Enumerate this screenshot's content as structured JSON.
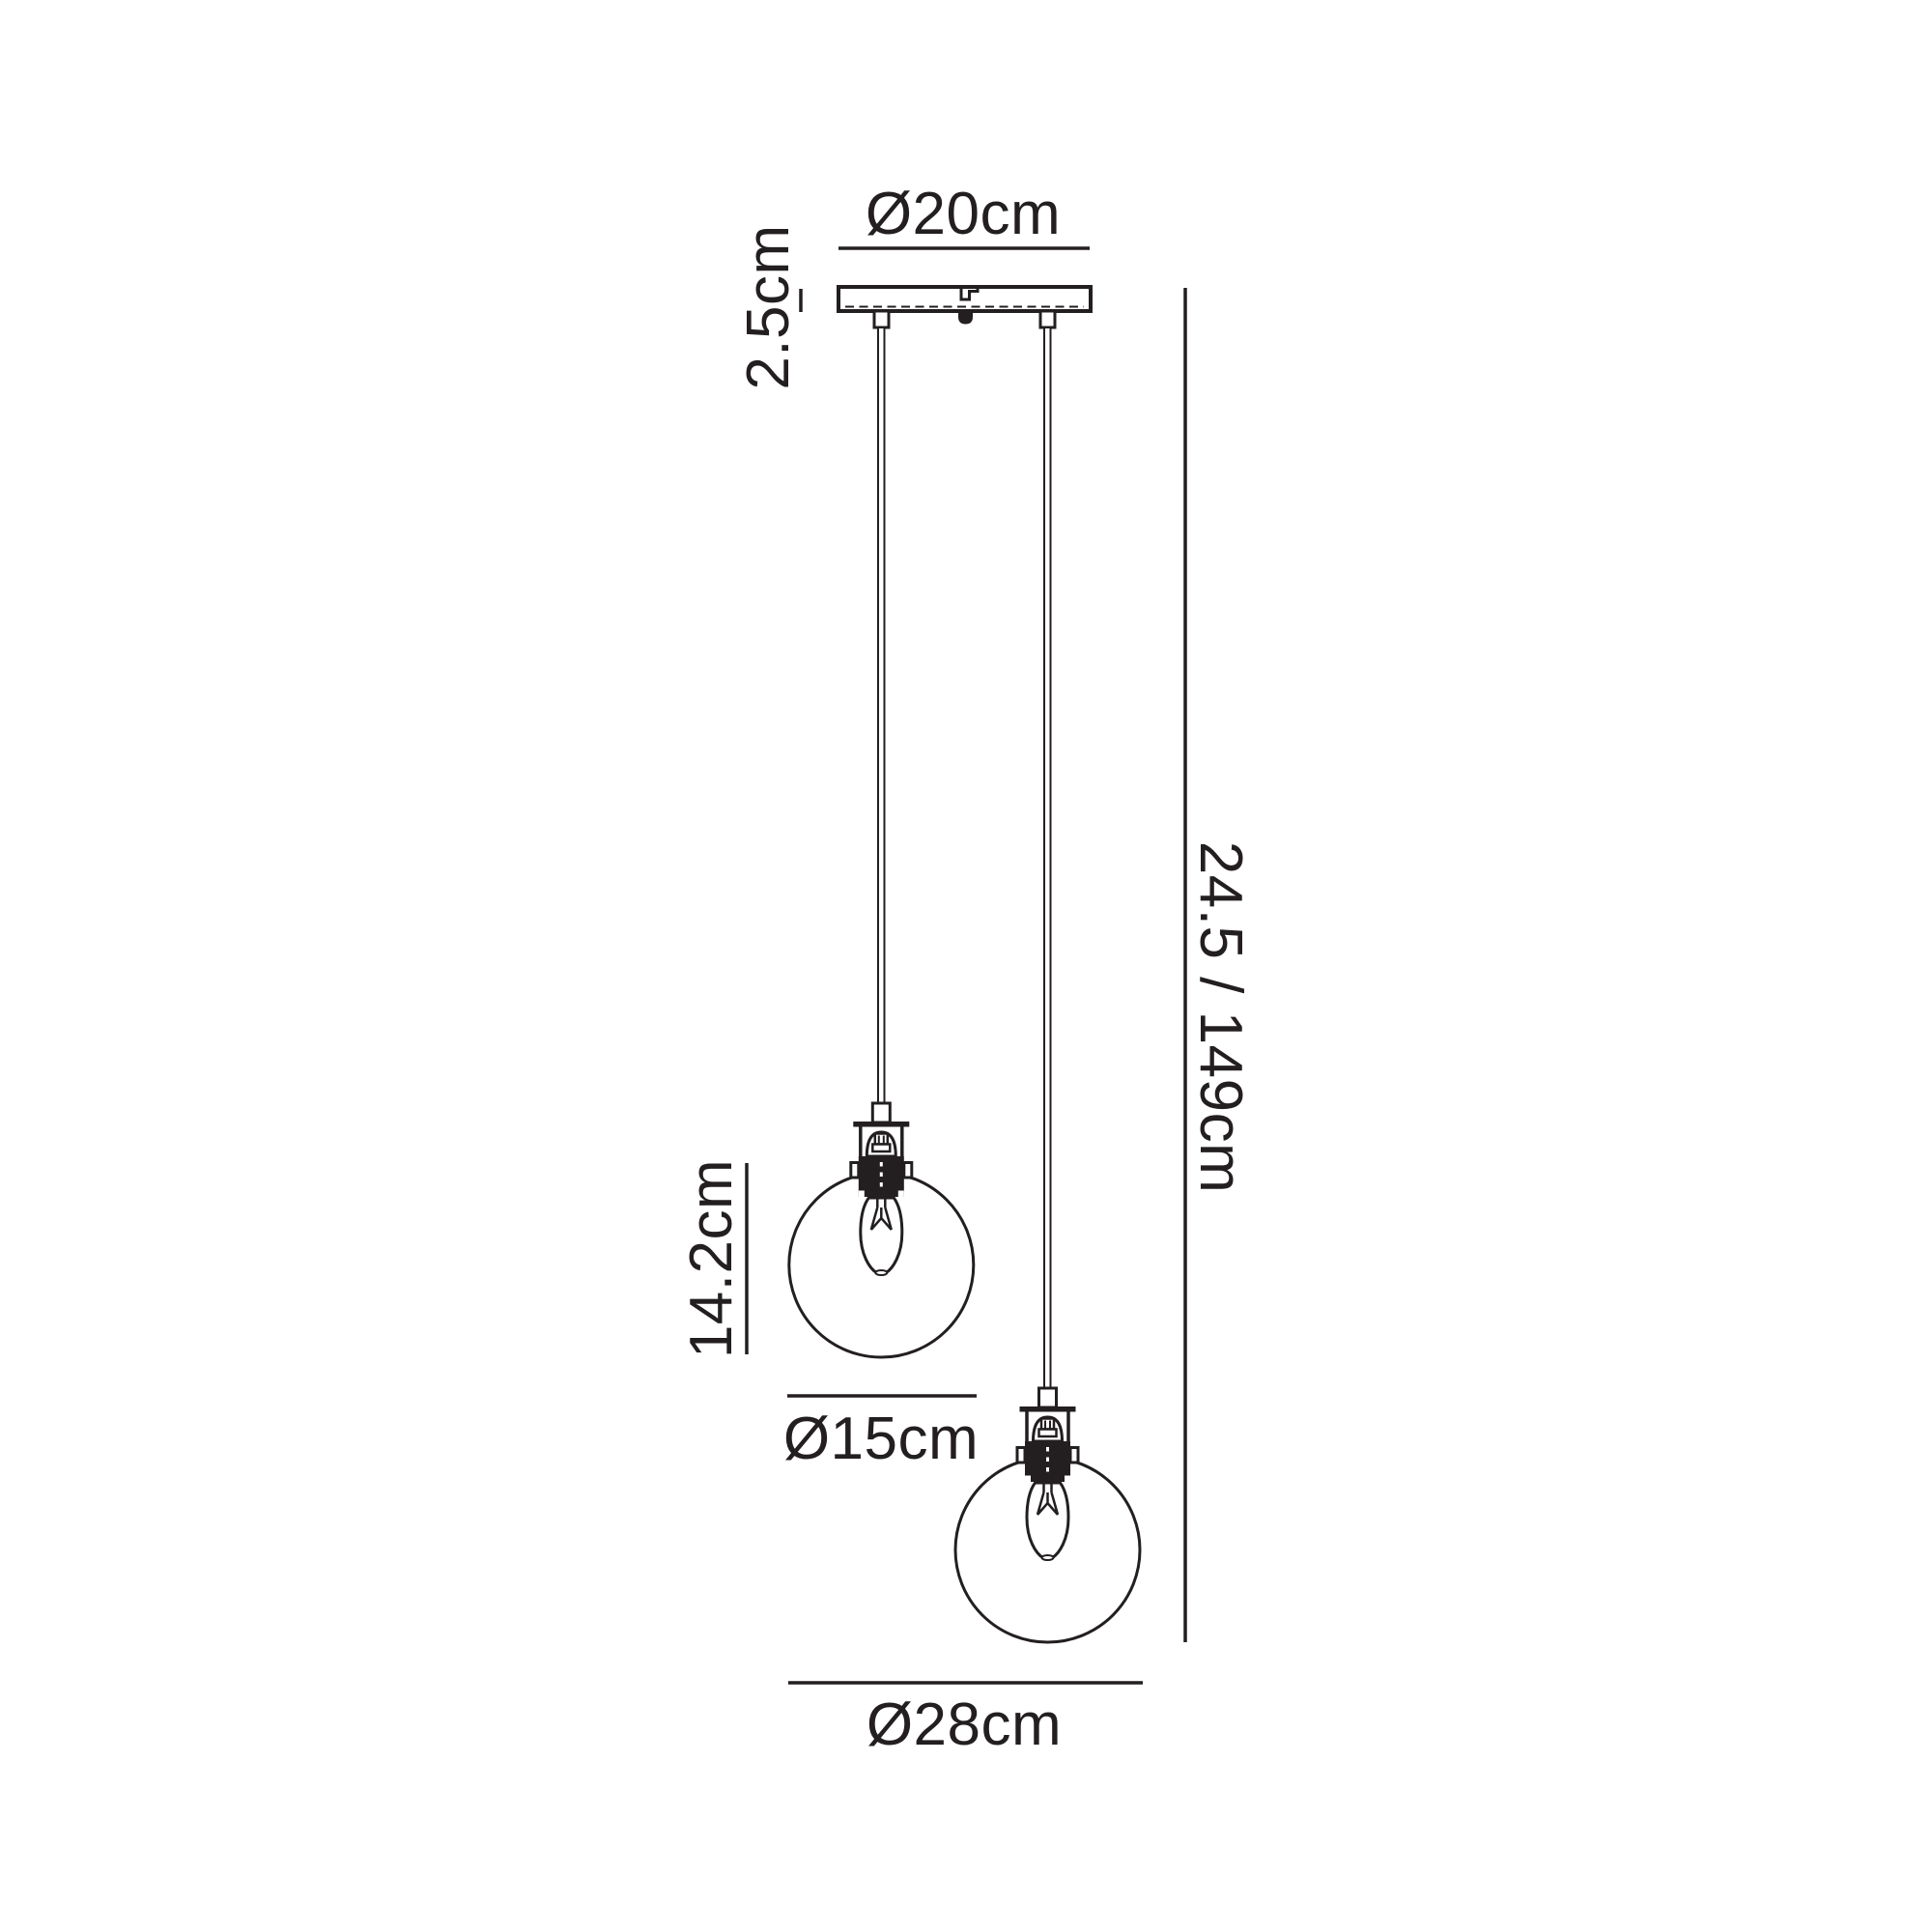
{
  "diagram": {
    "type": "pendant-light-dimension-drawing",
    "description": "Line drawing of a 2-light ceiling pendant with round glass globes and dimension annotations",
    "line_color": "#231f20",
    "background_color": "#ffffff",
    "labels": {
      "canopy_diameter": "Ø20cm",
      "canopy_depth": "2.5cm",
      "drop_min_max": "24.5 / 149cm",
      "shade_unit_height": "14.2cm",
      "globe_diameter": "Ø15cm",
      "overall_spread": "Ø28cm"
    }
  }
}
